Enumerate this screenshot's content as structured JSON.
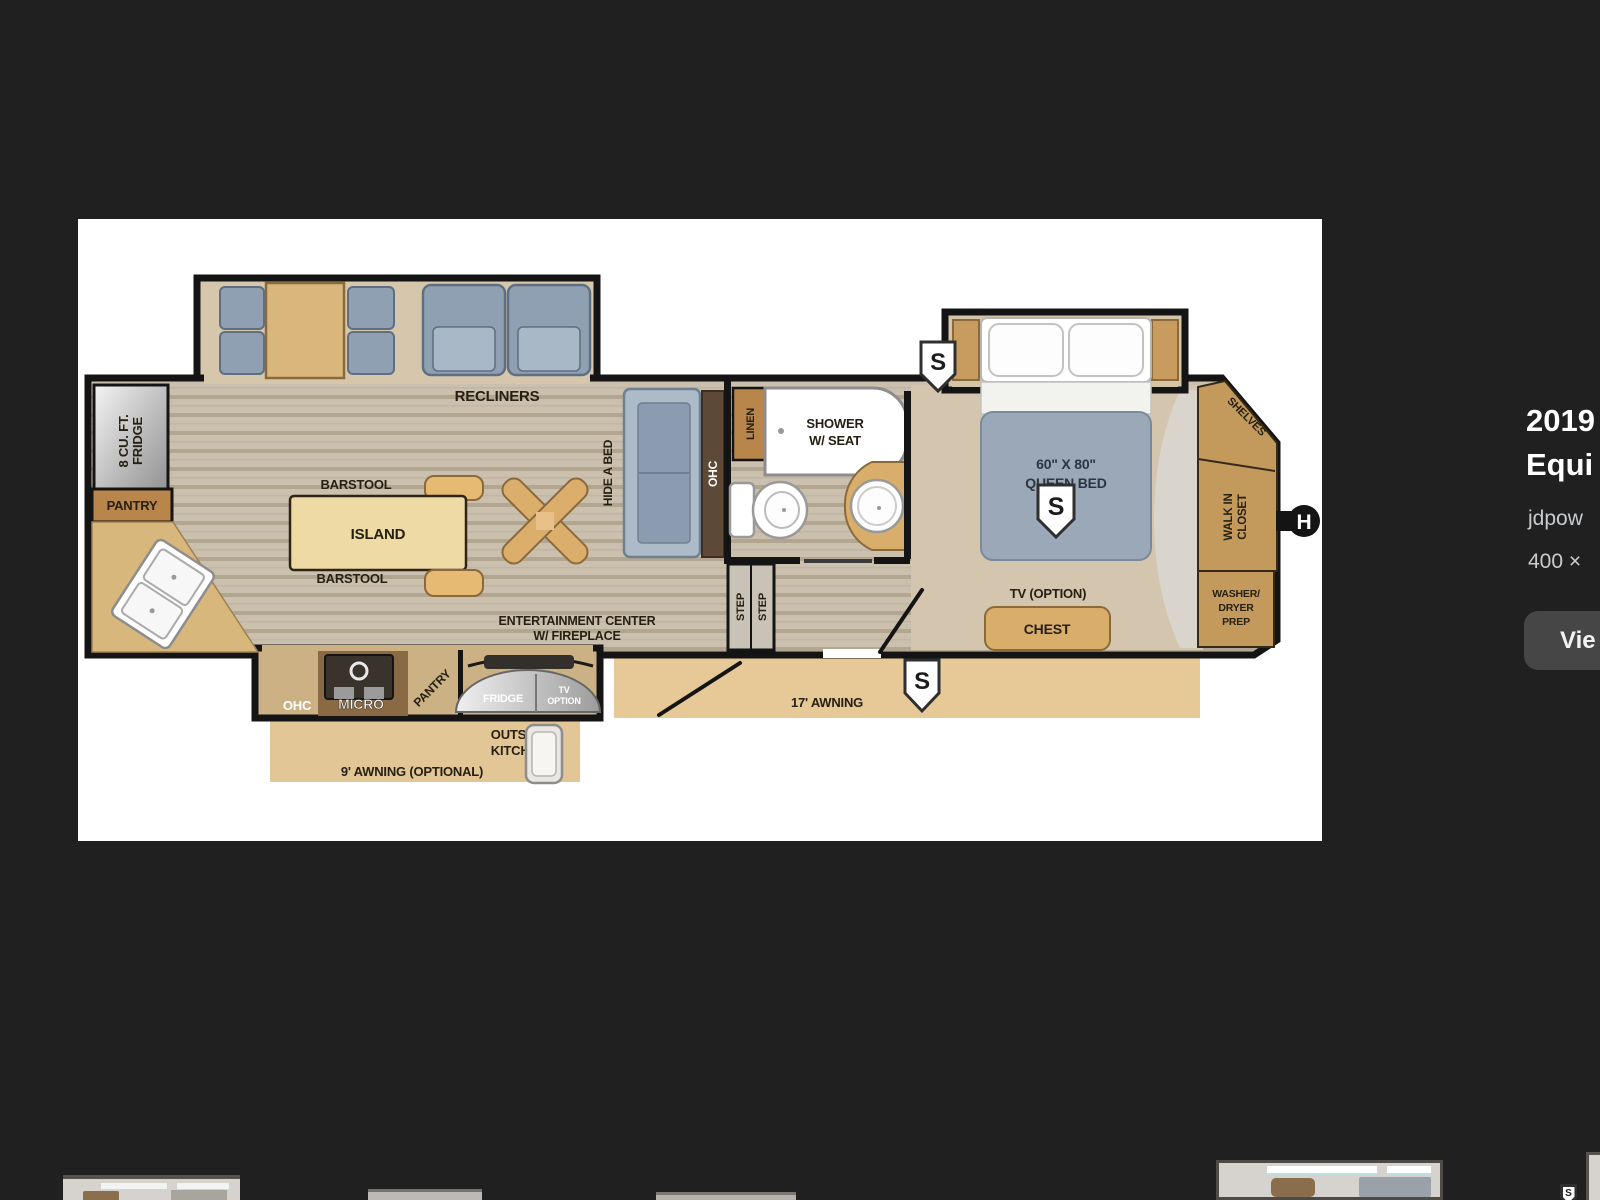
{
  "sidebar": {
    "title_line1": "2019",
    "title_line2": "Equi",
    "source": "jdpow",
    "dimensions": "400 ×",
    "view_button": "Vie"
  },
  "floorplan": {
    "labels": {
      "fridge_line1": "8 CU. FT.",
      "fridge_line2": "FRIDGE",
      "pantry": "PANTRY",
      "recliners": "RECLINERS",
      "barstool": "BARSTOOL",
      "island": "ISLAND",
      "hide_a_bed": "HIDE A BED",
      "ohc": "OHC",
      "linen": "LINEN",
      "shower_line1": "SHOWER",
      "shower_line2": "W/ SEAT",
      "step": "STEP",
      "bed_size": "60\" X 80\"",
      "bed_name": "QUEEN BED",
      "speaker": "S",
      "entertainment_line1": "ENTERTAINMENT CENTER",
      "entertainment_line2": "W/ FIREPLACE",
      "tv_option": "TV (OPTION)",
      "chest": "CHEST",
      "shelves": "SHELVES",
      "closet_line1": "WALK IN",
      "closet_line2": "CLOSET",
      "washer_line1": "WASHER/",
      "washer_line2": "DRYER",
      "washer_line3": "PREP",
      "hitch": "H",
      "awning17": "17' AWNING",
      "awning9": "9' AWNING (OPTIONAL)",
      "micro": "MICRO",
      "fridge_outside": "FRIDGE",
      "tv_small_line1": "TV",
      "tv_small_line2": "OPTION",
      "outside_kitchen_line1": "OUTSIDE",
      "outside_kitchen_line2": "KITCHEN"
    }
  },
  "colors": {
    "background": "#202020",
    "panel": "#ffffff",
    "cabinet_tan": "#c49a5c",
    "upholstery": "#93a3b6",
    "awning": "#e4c795",
    "button": "#464646"
  }
}
